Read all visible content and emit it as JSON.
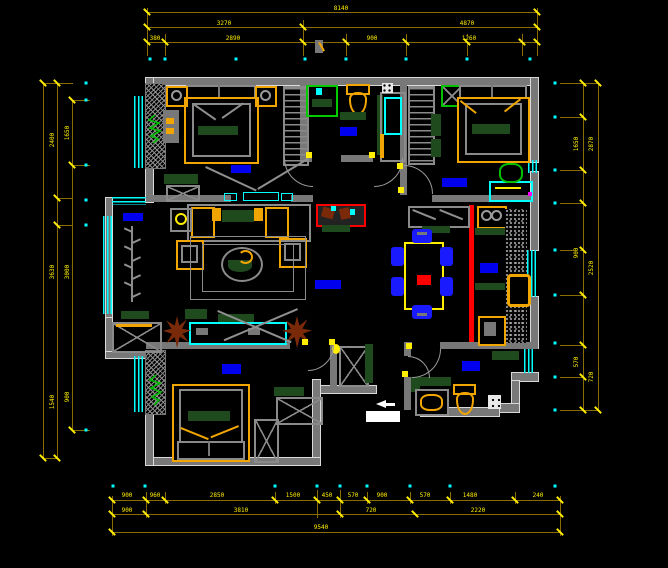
{
  "drawing": {
    "type": "cad-apartment-floor-plan",
    "background": "#000000",
    "colors": {
      "wall": "#787878",
      "outer_wall_edge": "#d9d9d9",
      "window": "#00ffff",
      "dimension_line": "#8a6d00",
      "dimension_text": "#ffee00",
      "furniture_accent": "#f0a500",
      "table_outline": "#ffee00",
      "soft_furnishing": "#1e4a1e",
      "room_label_block": "#0000ee",
      "chair": "#1a1aff",
      "kitchen_divider": "#ff0000",
      "plant_brown": "#7a2a08",
      "plant_green": "#00bb00",
      "fixture_white": "#e8e8e8"
    }
  },
  "dim_labels": [
    [
      "8140",
      341,
      9,
      0
    ],
    [
      "3270",
      224,
      24,
      0
    ],
    [
      "4870",
      467,
      24,
      0
    ],
    [
      "380",
      155,
      39,
      0
    ],
    [
      "2890",
      233,
      39,
      0
    ],
    [
      "900",
      372,
      39,
      0
    ],
    [
      "1260",
      469,
      39,
      0
    ],
    [
      "900",
      127,
      496,
      0
    ],
    [
      "960",
      155,
      496,
      0
    ],
    [
      "2850",
      217,
      496,
      0
    ],
    [
      "1500",
      293,
      496,
      0
    ],
    [
      "450",
      327,
      496,
      0
    ],
    [
      "570",
      353,
      496,
      0
    ],
    [
      "900",
      382,
      496,
      0
    ],
    [
      "570",
      425,
      496,
      0
    ],
    [
      "1480",
      470,
      496,
      0
    ],
    [
      "240",
      538,
      496,
      0
    ],
    [
      "900",
      127,
      511,
      0
    ],
    [
      "3810",
      241,
      511,
      0
    ],
    [
      "720",
      371,
      511,
      0
    ],
    [
      "2220",
      478,
      511,
      0
    ],
    [
      "9540",
      321,
      528,
      0
    ],
    [
      "2400",
      53,
      140,
      1
    ],
    [
      "3630",
      53,
      272,
      1
    ],
    [
      "1540",
      53,
      402,
      1
    ],
    [
      "1650",
      68,
      133,
      1
    ],
    [
      "3000",
      68,
      272,
      1
    ],
    [
      "900",
      68,
      397,
      1
    ],
    [
      "1650",
      577,
      144,
      1
    ],
    [
      "900",
      577,
      253,
      1
    ],
    [
      "570",
      577,
      362,
      1
    ],
    [
      "2870",
      592,
      144,
      1
    ],
    [
      "2520",
      592,
      268,
      1
    ],
    [
      "720",
      592,
      377,
      1
    ]
  ],
  "ticks": [
    [
      147,
      12
    ],
    [
      537,
      12
    ],
    [
      147,
      27
    ],
    [
      303,
      27
    ],
    [
      537,
      27
    ],
    [
      147,
      42
    ],
    [
      165,
      42
    ],
    [
      303,
      42
    ],
    [
      346,
      42
    ],
    [
      406,
      42
    ],
    [
      467,
      42
    ],
    [
      522,
      42
    ],
    [
      537,
      42
    ],
    [
      112,
      500
    ],
    [
      146,
      500
    ],
    [
      165,
      500
    ],
    [
      275,
      500
    ],
    [
      317,
      500
    ],
    [
      340,
      500
    ],
    [
      367,
      500
    ],
    [
      410,
      500
    ],
    [
      450,
      500
    ],
    [
      515,
      500
    ],
    [
      560,
      500
    ],
    [
      112,
      514
    ],
    [
      146,
      514
    ],
    [
      340,
      514
    ],
    [
      415,
      514
    ],
    [
      560,
      514
    ],
    [
      112,
      532
    ],
    [
      560,
      532
    ],
    [
      43,
      83
    ],
    [
      43,
      458
    ],
    [
      57,
      83
    ],
    [
      57,
      198
    ],
    [
      57,
      225
    ],
    [
      57,
      458
    ],
    [
      72,
      100
    ],
    [
      72,
      165
    ],
    [
      72,
      430
    ],
    [
      583,
      83
    ],
    [
      583,
      117
    ],
    [
      583,
      170
    ],
    [
      583,
      203
    ],
    [
      583,
      250
    ],
    [
      583,
      295
    ],
    [
      583,
      345
    ],
    [
      583,
      377
    ],
    [
      583,
      410
    ],
    [
      598,
      83
    ],
    [
      598,
      410
    ]
  ],
  "dots": [
    [
      150,
      59
    ],
    [
      165,
      59
    ],
    [
      236,
      59
    ],
    [
      305,
      59
    ],
    [
      346,
      59
    ],
    [
      406,
      59
    ],
    [
      467,
      59
    ],
    [
      530,
      59
    ],
    [
      113,
      486
    ],
    [
      145,
      486
    ],
    [
      275,
      486
    ],
    [
      317,
      486
    ],
    [
      340,
      486
    ],
    [
      367,
      486
    ],
    [
      410,
      486
    ],
    [
      450,
      486
    ],
    [
      555,
      486
    ],
    [
      86,
      83
    ],
    [
      86,
      100
    ],
    [
      86,
      165
    ],
    [
      86,
      200
    ],
    [
      86,
      225
    ],
    [
      86,
      430
    ],
    [
      555,
      83
    ],
    [
      555,
      117
    ],
    [
      555,
      170
    ],
    [
      555,
      203
    ],
    [
      555,
      250
    ],
    [
      555,
      295
    ],
    [
      555,
      343
    ],
    [
      555,
      377
    ],
    [
      555,
      410
    ]
  ],
  "hinges": [
    [
      309,
      155
    ],
    [
      372,
      155
    ],
    [
      401,
      190
    ],
    [
      400,
      166
    ],
    [
      305,
      342
    ],
    [
      332,
      342
    ],
    [
      409,
      346
    ],
    [
      405,
      374
    ]
  ]
}
